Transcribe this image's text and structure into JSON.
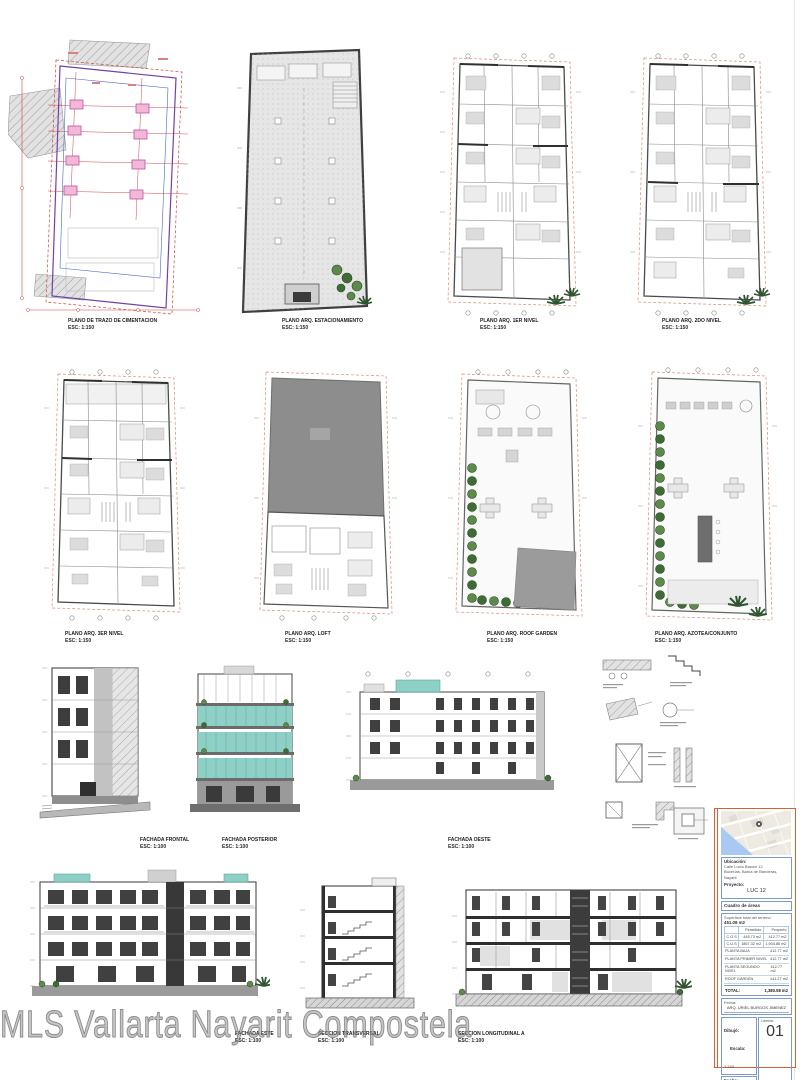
{
  "watermark": "MLS Vallarta Nayarit Compostela",
  "colors": {
    "accent_orange": "#d96030",
    "border_blue": "#7a9cc6",
    "glass_teal": "#8ecfc6",
    "column_pink": "#f2b8d8",
    "boundary_red": "#cc4444",
    "plant_green": "#4a7a3a",
    "wall_gray": "#4a4a4a"
  },
  "drawings": {
    "cimentacion": {
      "caption": "PLANO DE TRAZO DE CIMENTACION",
      "scale": "ESC: 1:150"
    },
    "estacionamiento": {
      "caption": "PLANO ARQ. ESTACIONAMIENTO",
      "scale": "ESC: 1:150"
    },
    "nivel1": {
      "caption": "PLANO ARQ. 1ER NIVEL",
      "scale": "ESC: 1:150"
    },
    "nivel2": {
      "caption": "PLANO ARQ. 2DO NIVEL",
      "scale": "ESC: 1:150"
    },
    "nivel3": {
      "caption": "PLANO ARQ. 3ER NIVEL",
      "scale": "ESC: 1:150"
    },
    "loft": {
      "caption": "PLANO ARQ. LOFT",
      "scale": "ESC: 1:150"
    },
    "roofgarden": {
      "caption": "PLANO ARQ. ROOF GARDEN",
      "scale": "ESC: 1:150"
    },
    "azotea": {
      "caption": "PLANO ARQ. AZOTEA/CONJUNTO",
      "scale": "ESC: 1:150"
    },
    "fachada_frontal": {
      "caption": "FACHADA FRONTAL",
      "scale": "ESC: 1:100"
    },
    "fachada_posterior": {
      "caption": "FACHADA POSTERIOR",
      "scale": "ESC: 1:100"
    },
    "fachada_oeste": {
      "caption": "FACHADA OESTE",
      "scale": "ESC: 1:100"
    },
    "fachada_este": {
      "caption": "FACHADA ESTE",
      "scale": "ESC: 1:100"
    },
    "seccion_transversal": {
      "caption": "SECCION TRANSVERSAL",
      "scale": "ESC: 1:100"
    },
    "seccion_longitudinal": {
      "caption": "SECCION LONGITUDINAL A",
      "scale": "ESC: 1:100"
    }
  },
  "titleblock": {
    "ubicacion_label": "Ubicación:",
    "address_line1": "Calle Lucio Blanco 12",
    "address_line2": "Bucerías, Bahía de Banderas, Nayarit",
    "proyecto_label": "Proyecto:",
    "proyecto_value": "LUC 12",
    "cuadro_label": "Cuadro de áreas",
    "superficie_label": "Superficie total del terreno",
    "superficie_value": "451.08 m2",
    "table": {
      "col_permitido": "Permitido",
      "col_proyecto": "Proyecto",
      "rows": [
        {
          "label": "C.O.S",
          "permitido": "445.73 m2",
          "proyecto": "412.77 m2"
        },
        {
          "label": "C.U.S",
          "permitido": "1867.32 m2",
          "proyecto": "1,904.86 m2"
        }
      ],
      "areas": [
        {
          "label": "PLANTA BAJA",
          "value": "412.77 m2"
        },
        {
          "label": "PLANTA PRIMER NIVEL",
          "value": "412.77 m2"
        },
        {
          "label": "PLANTA SEGUNDO NIVEL",
          "value": "412.77 m2"
        },
        {
          "label": "ROOF GARDEN",
          "value": "141.27 m2"
        }
      ],
      "total_label": "TOTAL:",
      "total_value": "1,380.58 m2"
    },
    "fecha_label": "Fecha:",
    "author": "ARQ. URIEL BURGOS JIMENEZ",
    "dibujo_label": "Dibujó:",
    "escala_label": "Escala:",
    "escala_value": "1:150",
    "fecha2_label": "Fecha:",
    "fecha2_value": "NOVIEMBRE 2021",
    "revision_label": "Revisión:",
    "revision_value": "00",
    "lamina_label": "Lámina:",
    "sheet_number": "01",
    "escala_grafica_label": "Escala gráfica:",
    "scale_numbers": [
      "0",
      "1",
      "2",
      "3",
      "4",
      "5"
    ]
  }
}
